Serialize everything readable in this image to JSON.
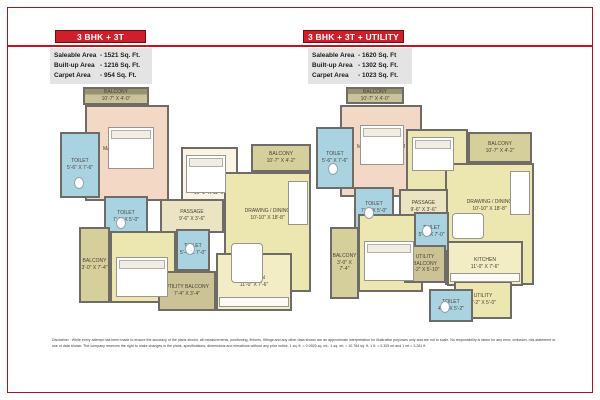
{
  "accent_colors": {
    "header_red": "#ce202b",
    "border_red": "#ae1317"
  },
  "page": {
    "disclaimer": "Disclaimer : While every attempt has been made to ensure the accuracy of the plans shown, all measurements, positioning, fixtures, fittings and any other data shown are an approximate interpretation for illustrative purposes only and are not to scale.  No responsibility is taken for any error, omission, mis-statement or use of data shown. The company reserves the right to make changes in the  plans, specifications, dimensions and elevations without any prior notice. 1 sq. ft. = 0.0929 sq. mt., 1 sq. mt. = 10.764 sq. ft, 1 ft. = 0.305 mt and 1 mt = 3.281 ft."
  },
  "plans": [
    {
      "title": "3 BHK + 3T",
      "areas": [
        {
          "label": "Saleable Area",
          "value": "-  1521 Sq. Ft."
        },
        {
          "label": "Built-up Area",
          "value": "-  1216 Sq. Ft."
        },
        {
          "label": "Carpet Area",
          "value": "-  954 Sq. Ft."
        }
      ],
      "rooms": [
        {
          "name": "BALCONY",
          "dims": "10'-7\" X 4'-0\""
        },
        {
          "name": "TOILET",
          "dims": "5'-6\" X 7'-6\""
        },
        {
          "name": "MASTER BEDROOM",
          "dims": "11'-0\" X 14'-6\""
        },
        {
          "name": "BED ROOM",
          "dims": "10'-1\" X 11'-6\""
        },
        {
          "name": "BALCONY",
          "dims": "10'-7\" X 4'-2\""
        },
        {
          "name": "DRAWING / DINING",
          "dims": "10'-10\" X 18'-8\""
        },
        {
          "name": "TOILET",
          "dims": "7'-6\" X 5'-0\""
        },
        {
          "name": "PASSAGE",
          "dims": "9'-6\" X 3'-6\""
        },
        {
          "name": "BALCONY",
          "dims": "3'-0\" X 7'-4\""
        },
        {
          "name": "BED ROOM",
          "dims": "12'-6\" X 11'-2\""
        },
        {
          "name": "TOILET",
          "dims": "5'-4\" X 7'-0\""
        },
        {
          "name": "UTILITY BALCONY",
          "dims": "7'-4\" X 3'-4\""
        },
        {
          "name": "KITCHEN",
          "dims": "11'-0\" X 7'-6\""
        }
      ]
    },
    {
      "title": "3 BHK + 3T + UTILITY",
      "areas": [
        {
          "label": "Saleable Area",
          "value": "-  1620 Sq. Ft"
        },
        {
          "label": "Built-up Area",
          "value": "-  1302 Sq. Ft."
        },
        {
          "label": "Carpet Area",
          "value": "-  1023 Sq. Ft."
        }
      ],
      "rooms": [
        {
          "name": "BALCONY",
          "dims": "10'-7\" X 4'-0\""
        },
        {
          "name": "TOILET",
          "dims": "5'-6\" X 7'-6\""
        },
        {
          "name": "MASTER BEDROOM",
          "dims": "11'-0\" X 14'-6\""
        },
        {
          "name": "BED ROOM",
          "dims": "10'-1\" X 11'-6\""
        },
        {
          "name": "BALCONY",
          "dims": "10'-7\" X 4'-2\""
        },
        {
          "name": "DRAWING / DINING",
          "dims": "10'-10\" X 18'-8\""
        },
        {
          "name": "TOILET",
          "dims": "7'-6\" X 5'-0\""
        },
        {
          "name": "PASSAGE",
          "dims": "9'-6\" X 3'-6\""
        },
        {
          "name": "BALCONY",
          "dims": "3'-0\" X 7'-4\""
        },
        {
          "name": "BED ROOM",
          "dims": "12'-6\" X 11'-2\""
        },
        {
          "name": "TOILET",
          "dims": "5'-4\" X 7'-0\""
        },
        {
          "name": "UTILITY BALCONY",
          "dims": "5'-2\" X 5'-10\""
        },
        {
          "name": "KITCHEN",
          "dims": "11'-0\" X 7'-6\""
        },
        {
          "name": "UTILITY",
          "dims": "7'-2\" X 5'-0\""
        },
        {
          "name": "TOILET",
          "dims": "4'-6\" X 5'-2\""
        }
      ]
    }
  ]
}
